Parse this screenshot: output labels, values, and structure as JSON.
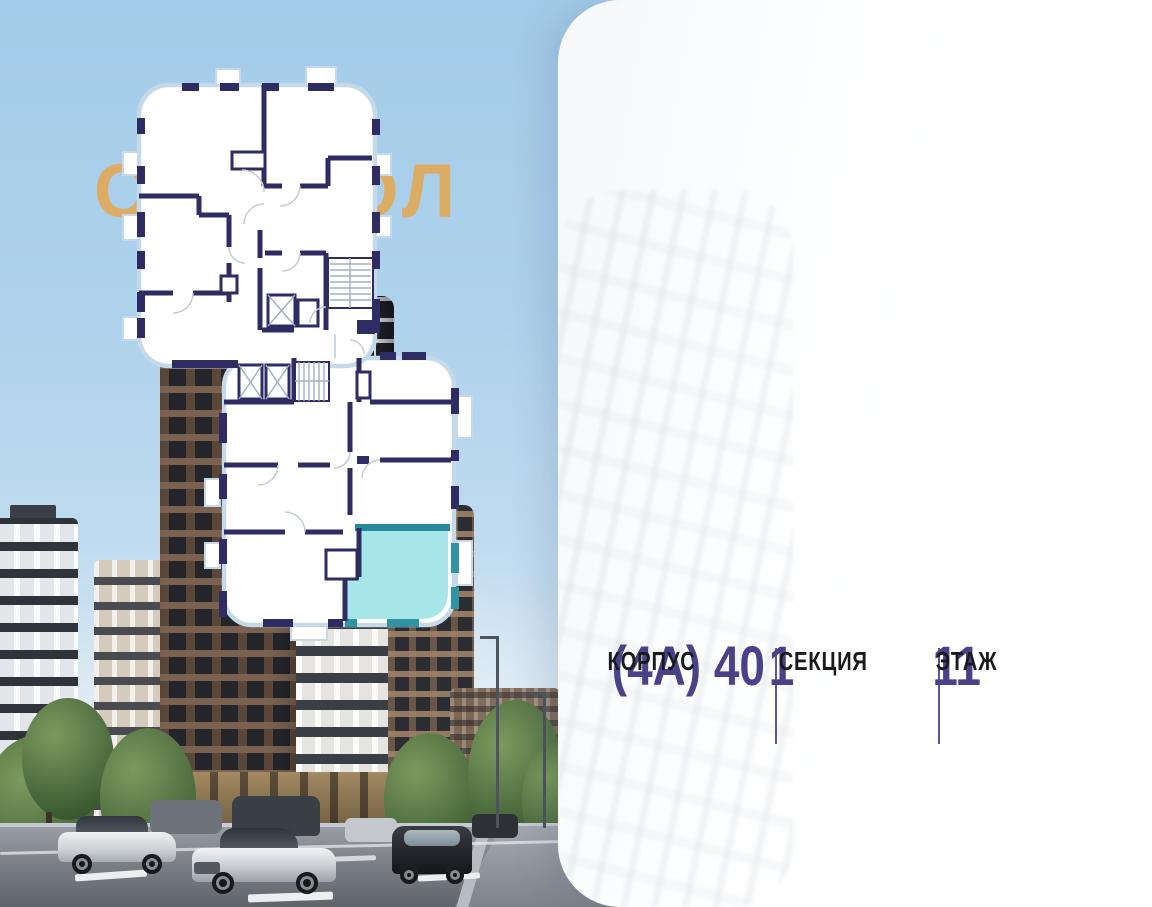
{
  "logo": {
    "text": "СИМВОЛ",
    "color": "#DCAB64"
  },
  "plan": {
    "highlight_fill": "#A6E6E8",
    "highlight_border": "#27899B",
    "wall_color": "#2E2C63",
    "outline_color": "#C6D9E8"
  },
  "info": {
    "building": {
      "value": "(4А) 40",
      "label": "КОРПУС"
    },
    "section": {
      "value": "1",
      "label": "СЕКЦИЯ"
    },
    "floor": {
      "value": "11",
      "label": "ЭТАЖ"
    },
    "accent_color": "#494289",
    "divider_color": "#5B54A0"
  }
}
